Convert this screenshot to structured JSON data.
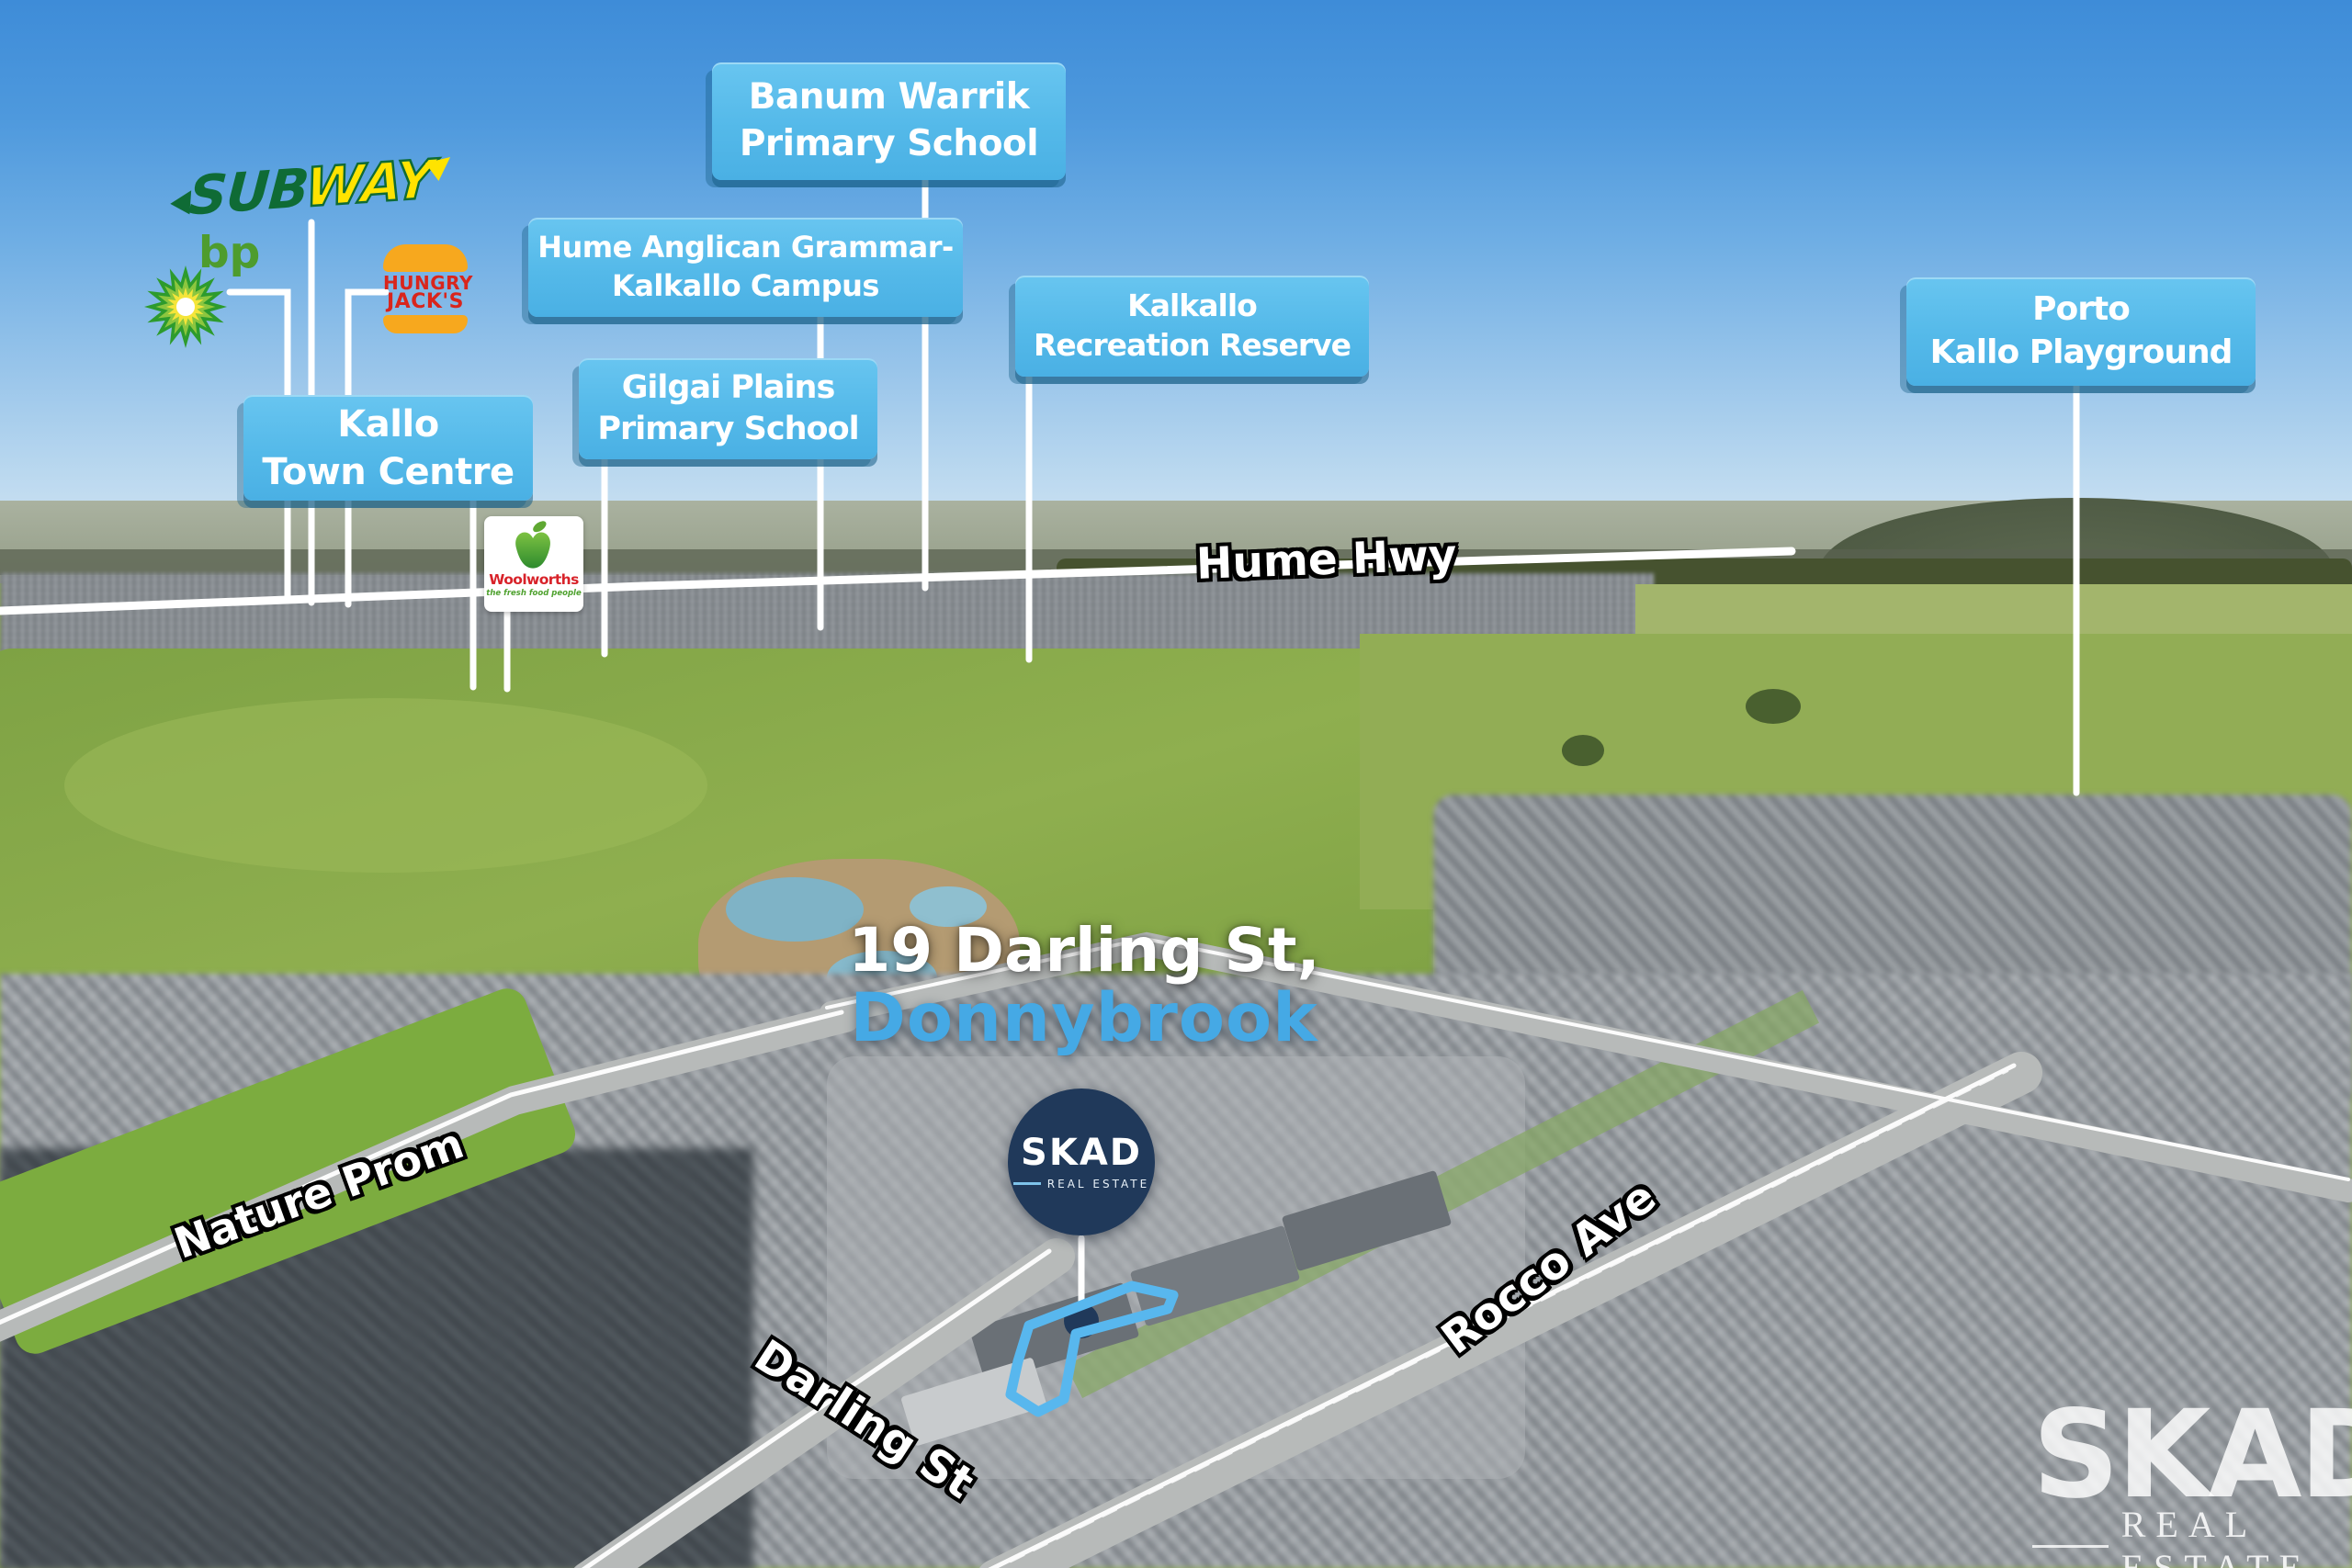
{
  "callouts": {
    "banum_warrik": {
      "line1": "Banum Warrik",
      "line2": "Primary School"
    },
    "hume_anglican": {
      "line1": "Hume Anglican Grammar-",
      "line2": "Kalkallo Campus"
    },
    "kalkallo_reserve": {
      "line1": "Kalkallo",
      "line2": "Recreation Reserve"
    },
    "porto_kallo": {
      "line1": "Porto",
      "line2": "Kallo Playground"
    },
    "gilgai_plains": {
      "line1": "Gilgai Plains",
      "line2": "Primary School"
    },
    "kallo_town_centre": {
      "line1": "Kallo",
      "line2": "Town Centre"
    }
  },
  "roads": {
    "hume_hwy": "Hume Hwy",
    "nature_prom": "Nature Prom",
    "darling_st": "Darling St",
    "rocco_ave": "Rocco Ave"
  },
  "property": {
    "address_line1": "19 Darling St,",
    "address_line2": "Donnybrook"
  },
  "logos": {
    "subway": {
      "part1": "SUB",
      "part2": "WAY"
    },
    "bp": {
      "name": "bp"
    },
    "hungry_jacks": {
      "line1": "HUNGRY",
      "line2": "JACK'S"
    },
    "woolworths": {
      "name": "Woolworths",
      "tagline": "the fresh food people"
    }
  },
  "branding": {
    "map_pin_logo": {
      "name": "SKAD",
      "subtitle": "REAL ESTATE"
    },
    "watermark": {
      "name": "SKAD",
      "subtitle": "REAL ESTATE"
    }
  },
  "colors": {
    "callout_blue": "#52B7E8",
    "accent_blue": "#45A9E5",
    "navy": "#20395A",
    "property_outline_blue": "#58B7EE",
    "subway_green": "#0F6B35",
    "subway_yellow": "#FFE300",
    "bp_green": "#4E9C2E",
    "hungry_jacks_red": "#D9251C",
    "hungry_jacks_orange": "#F7A81E",
    "woolworths_red": "#D8232A",
    "woolworths_green": "#4EA12E"
  }
}
